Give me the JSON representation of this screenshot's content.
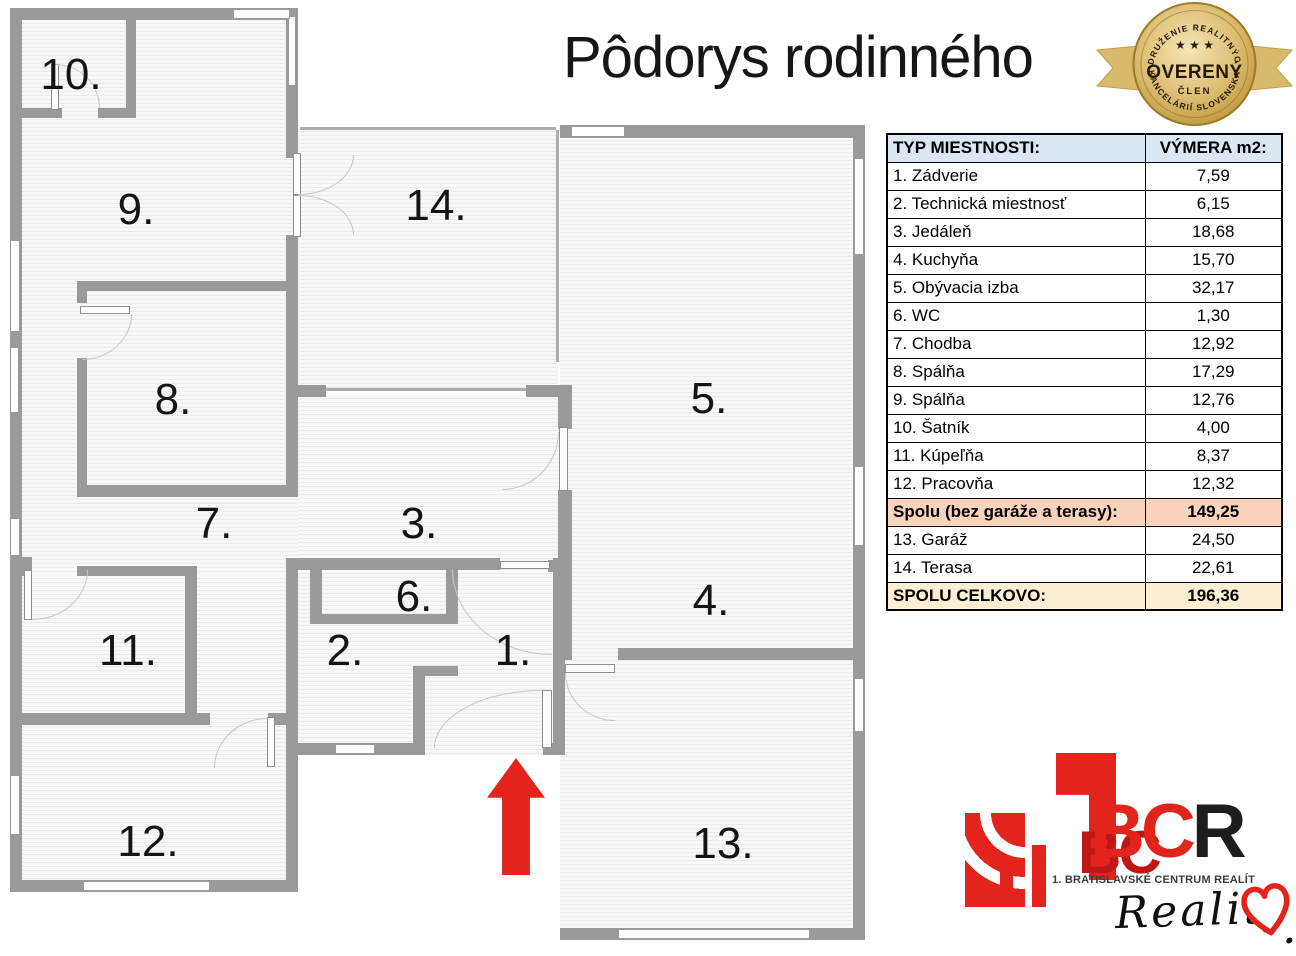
{
  "page_title": "Pôdorys rodinného",
  "badge": {
    "top_text": "ZDRUŽENIE REALITNÝCH",
    "bottom_text": "KANCELÁRIÍ SLOVENSKA",
    "stars": "★ ★ ★",
    "center": "OVERENÝ",
    "sub": "ČLEN"
  },
  "plan": {
    "rooms": [
      {
        "number": "1."
      },
      {
        "number": "2."
      },
      {
        "number": "3."
      },
      {
        "number": "4."
      },
      {
        "number": "5."
      },
      {
        "number": "6."
      },
      {
        "number": "7."
      },
      {
        "number": "8."
      },
      {
        "number": "9."
      },
      {
        "number": "10."
      },
      {
        "number": "11."
      },
      {
        "number": "12."
      },
      {
        "number": "13."
      },
      {
        "number": "14."
      }
    ]
  },
  "table": {
    "header": {
      "type": "TYP MIESTNOSTI:",
      "area": "VÝMERA m2:"
    },
    "rows": [
      {
        "label": "1. Zádverie",
        "value": "7,59",
        "type": "normal"
      },
      {
        "label": "2. Technická miestnosť",
        "value": "6,15",
        "type": "normal"
      },
      {
        "label": "3. Jedáleň",
        "value": "18,68",
        "type": "normal"
      },
      {
        "label": "4. Kuchyňa",
        "value": "15,70",
        "type": "normal"
      },
      {
        "label": "5. Obývacia izba",
        "value": "32,17",
        "type": "normal"
      },
      {
        "label": "6. WC",
        "value": "1,30",
        "type": "normal"
      },
      {
        "label": "7. Chodba",
        "value": "12,92",
        "type": "normal"
      },
      {
        "label": "8. Spálňa",
        "value": "17,29",
        "type": "normal"
      },
      {
        "label": "9. Spálňa",
        "value": "12,76",
        "type": "normal"
      },
      {
        "label": "10. Šatník",
        "value": "4,00",
        "type": "normal"
      },
      {
        "label": "11. Kúpeľňa",
        "value": "8,37",
        "type": "normal"
      },
      {
        "label": "12. Pracovňa",
        "value": "12,32",
        "type": "normal"
      },
      {
        "label": "Spolu (bez garáže a terasy):",
        "value": "149,25",
        "type": "subtotal"
      },
      {
        "label": "13. Garáž",
        "value": "24,50",
        "type": "normal"
      },
      {
        "label": "14. Terasa",
        "value": "22,61",
        "type": "normal"
      },
      {
        "label": "SPOLU CELKOVO:",
        "value": "196,36",
        "type": "total"
      }
    ]
  },
  "logo": {
    "one": "1",
    "bc": "BC",
    "r": "R",
    "shadow": "BC",
    "caption": "1. BRATISLAVSKÉ CENTRUM REALÍT",
    "script": "Reality",
    "period": "."
  },
  "colors": {
    "red": "#E3241D",
    "wall_gray": "#9A9A9A",
    "header_bg": "#DBE8F4",
    "subtotal_bg": "#FAD3BC",
    "total_bg": "#FBEED3",
    "badge_gold": "#DDBD72"
  }
}
